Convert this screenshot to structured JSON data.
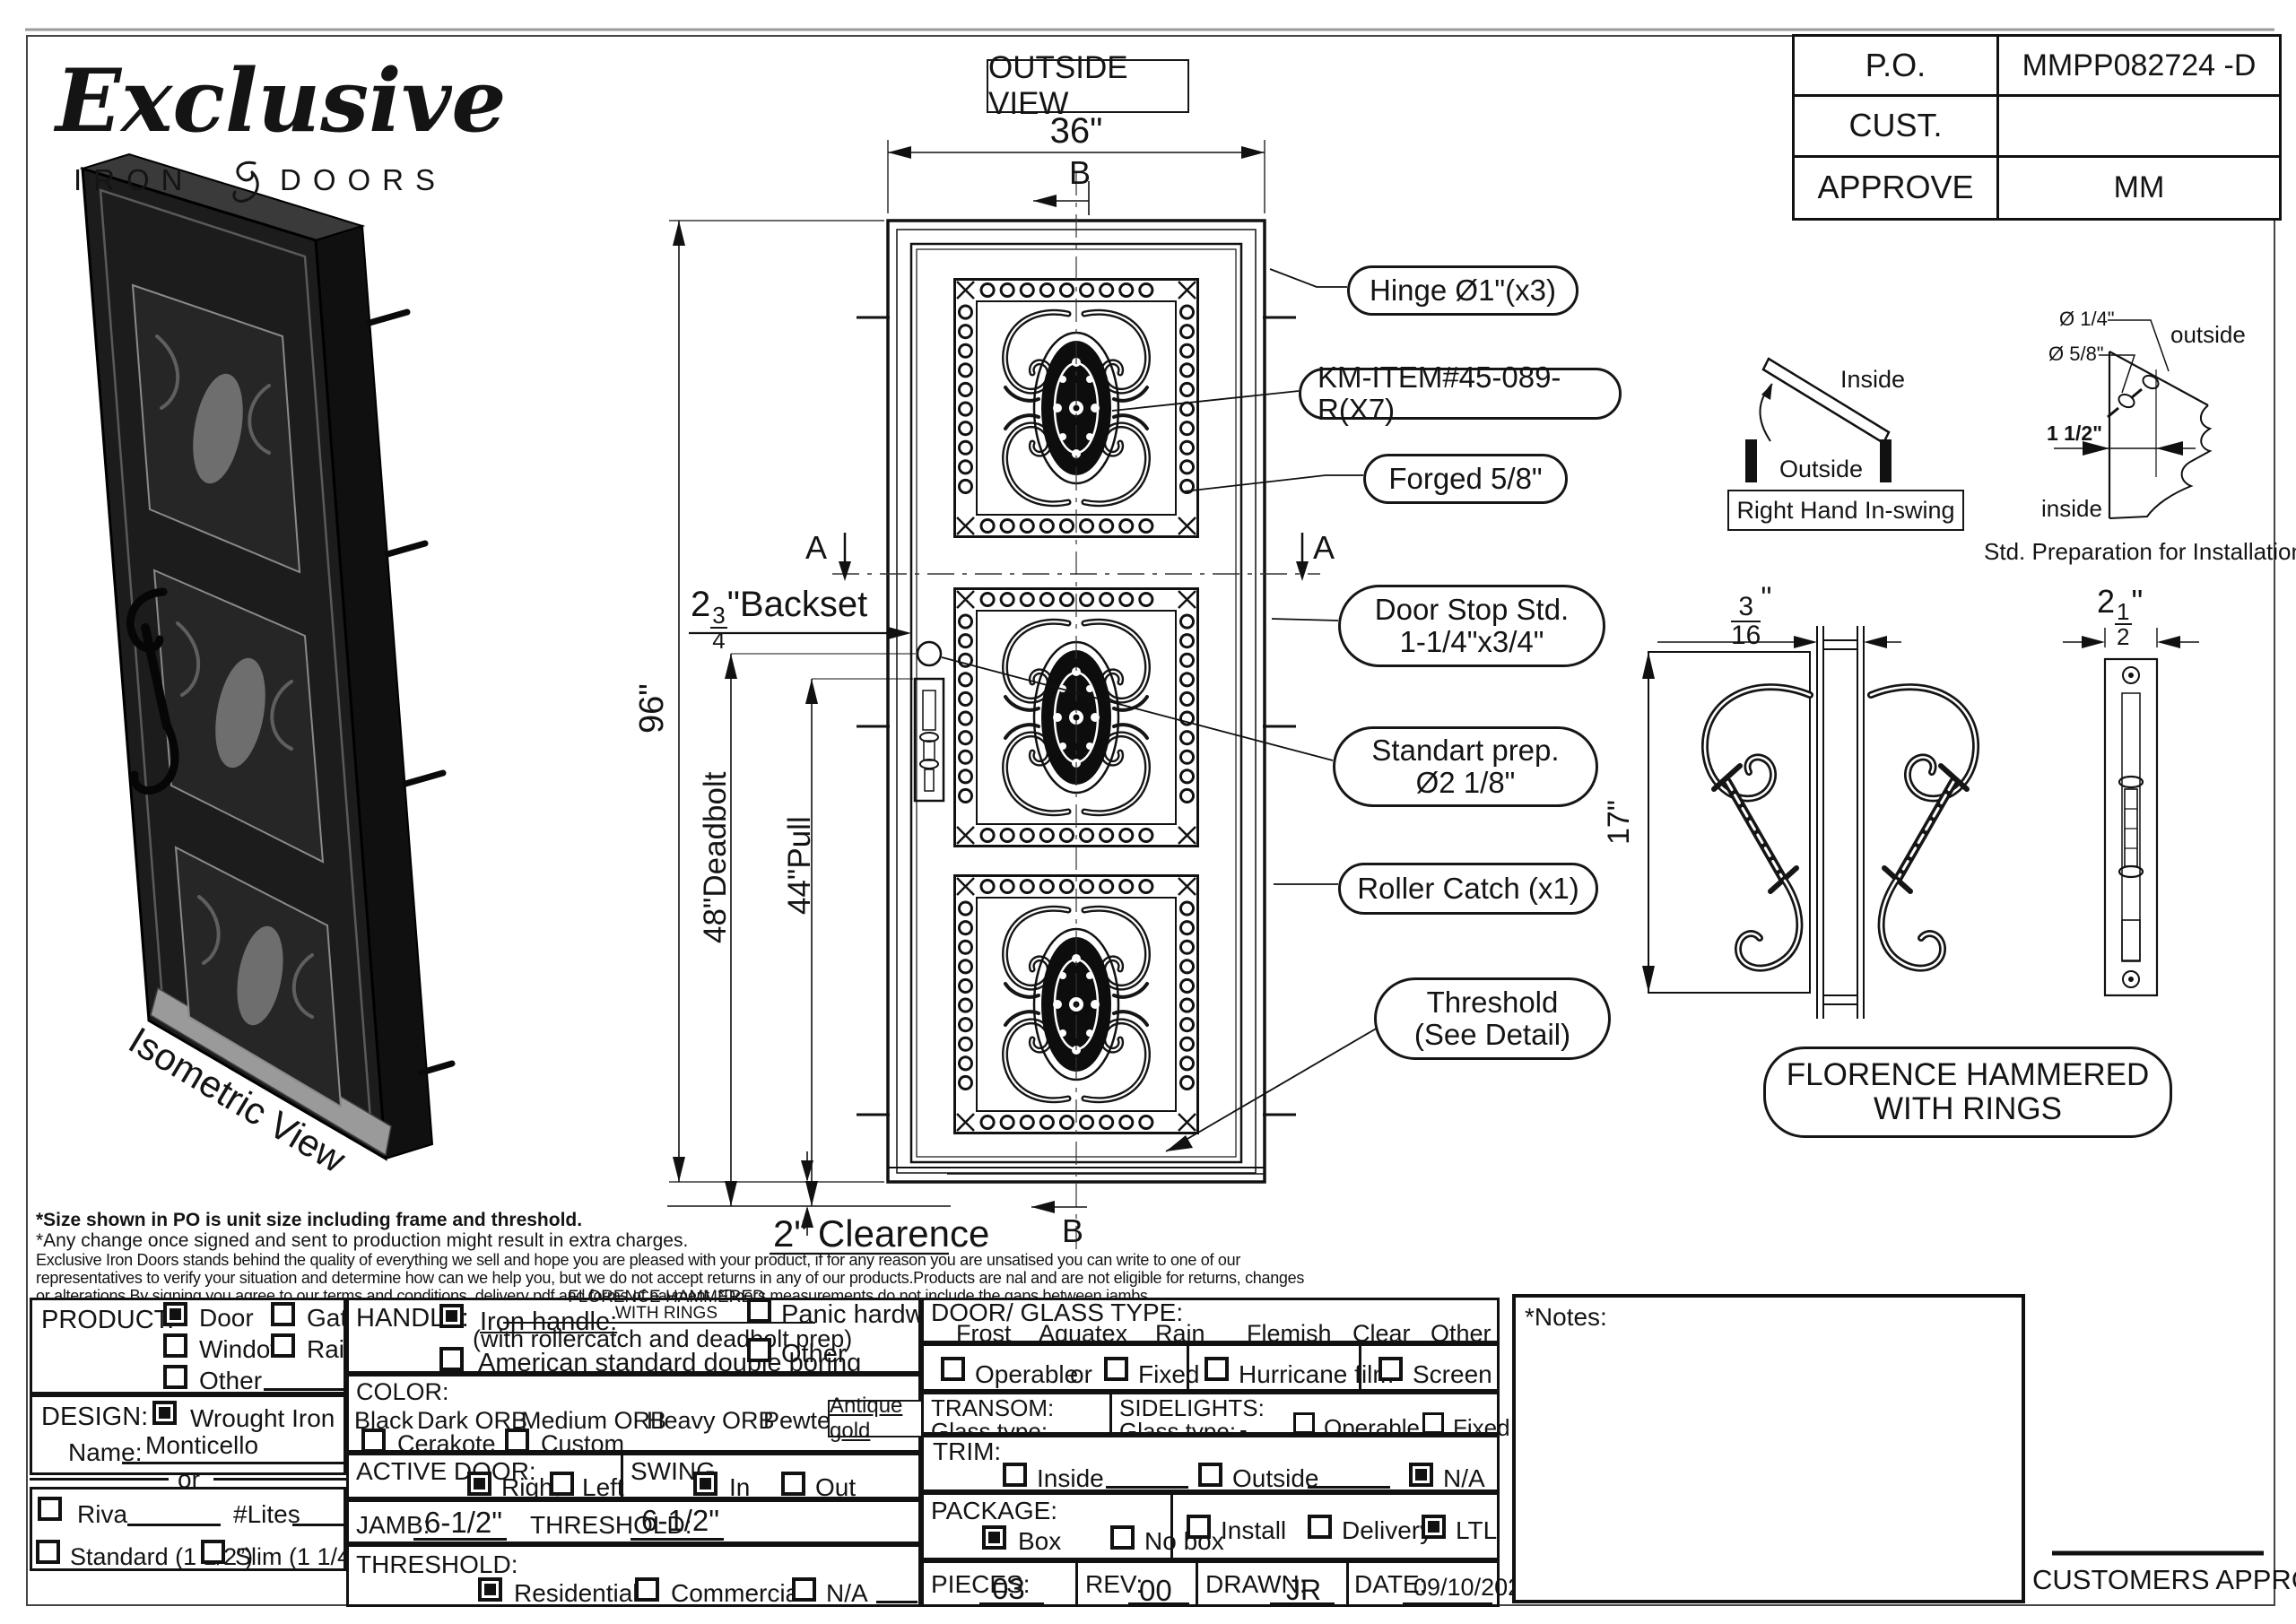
{
  "logo": {
    "name": "Exclusive",
    "tagline_left": "IRON",
    "tagline_right": "DOORS"
  },
  "po_table": {
    "po_label": "P.O.",
    "po_value": "MMPP082724 -D",
    "cust_label": "CUST.",
    "cust_value": "",
    "approve_label": "APPROVE",
    "approve_value": "MM"
  },
  "drawing": {
    "view_title": "OUTSIDE VIEW",
    "width_dim": "36\"",
    "height_dim": "96\"",
    "section_a": "A",
    "section_b": "B",
    "backset_whole": "2",
    "backset_num": "3",
    "backset_den": "4",
    "backset_text": "\"Backset",
    "deadbolt_dim": "48\"Deadbolt",
    "pull_dim": "44\"Pull",
    "clearance_dim": "2\" Clearence",
    "callouts": {
      "hinge": "Hinge Ø1\"(x3)",
      "km_item": "KM-ITEM#45-089-R(X7)",
      "forged": "Forged 5/8\"",
      "door_stop_1": "Door Stop Std.",
      "door_stop_2": "1-1/4\"x3/4\"",
      "prep_1": "Standart prep.",
      "prep_2": "Ø2 1/8\"",
      "roller": "Roller Catch (x1)",
      "threshold_1": "Threshold",
      "threshold_2": "(See Detail)"
    },
    "isometric_label": "Isometric View"
  },
  "swing_diagram": {
    "inside": "Inside",
    "outside": "Outside",
    "label": "Right Hand In-swing"
  },
  "prep_diagram": {
    "dia1": "Ø 1/4\"",
    "dia2": "Ø 5/8\"",
    "offset": "1 1/2\"",
    "outside": "outside",
    "inside": "inside",
    "caption": "Std. Preparation for Installation"
  },
  "handle_detail": {
    "gap_num": "3",
    "gap_den": "16",
    "gap_unit": "\"",
    "height_dim": "17\"",
    "width_whole": "2",
    "width_num": "1",
    "width_den": "2",
    "width_unit": "\"",
    "name_line1": "FLORENCE HAMMERED",
    "name_line2": "WITH RINGS"
  },
  "disclaimer": {
    "line1": "*Size shown in PO is unit size including frame and threshold.",
    "line2": "*Any change once signed and sent to production might result in extra charges.",
    "line3": "Exclusive Iron Doors stands behind the quality of everything we sell and hope you are pleased with your product, if for any reason you are unsatised you can write to one of our",
    "line4": "representatives to verify your situation and determine how can we help you, but we do not accept returns in any of our products.Products are nal and are not eligible for returns, changes",
    "line5": "or alterations.By signing you agree to our terms and conditions, delivery pdf and forms of payment. *Doors measurements do not include the gaps between jambs"
  },
  "form": {
    "product": {
      "label": "PRODUCT:",
      "options": [
        {
          "label": "Door",
          "checked": true
        },
        {
          "label": "Gate",
          "checked": false
        },
        {
          "label": "Window",
          "checked": false
        },
        {
          "label": "Railling",
          "checked": false
        },
        {
          "label": "Other",
          "checked": false
        }
      ]
    },
    "design": {
      "label": "DESIGN:",
      "wrought": {
        "label": "Wrought Iron",
        "checked": true
      },
      "name_label": "Name:",
      "name_value": "Monticello",
      "or": "or",
      "riva": {
        "label": "Riva",
        "checked": false
      },
      "lites_label": "#Lites",
      "standard": {
        "label": "Standard (1 1/2”)",
        "checked": false
      },
      "slim": {
        "label": "Slim (1 1/4”)",
        "checked": false
      }
    },
    "handle": {
      "label": "HANDLE:",
      "iron": {
        "label": "Iron handle:",
        "checked": true
      },
      "iron_value1": "FLORENCE HAMMERED",
      "iron_value2": "WITH RINGS",
      "iron_sub": "(with rollercatch and deadbolt prep)",
      "american": {
        "label": "American standard double boring",
        "checked": false
      },
      "panic": {
        "label": "Panic hardware",
        "checked": false
      },
      "other": {
        "label": "Other",
        "checked": false
      }
    },
    "color": {
      "label": "COLOR:",
      "opt1": "Black",
      "opt2": "Dark ORB",
      "opt3": "Medium ORB",
      "opt4": "Heavy ORB",
      "opt5": "Pewter",
      "selected": "Antique gold",
      "cerakote": {
        "label": "Cerakote",
        "checked": false
      },
      "custom": {
        "label": "Custom",
        "checked": false
      }
    },
    "active_door": {
      "label": "ACTIVE DOOR:",
      "right": {
        "label": "Right",
        "checked": true
      },
      "left": {
        "label": "Left",
        "checked": false
      }
    },
    "swing": {
      "label": "SWING",
      "in": {
        "label": "In",
        "checked": true
      },
      "out": {
        "label": "Out",
        "checked": false
      }
    },
    "jamb": {
      "label": "JAMB:",
      "value": "6-1/2\"",
      "threshold_label": "THRESHOLD:",
      "threshold_value": "6-1/2\""
    },
    "threshold": {
      "label": "THRESHOLD:",
      "residential": {
        "label": "Residential",
        "checked": true
      },
      "commercial": {
        "label": "Commercial",
        "checked": false
      },
      "na": {
        "label": "N/A",
        "checked": false
      }
    },
    "glass": {
      "label": "DOOR/ GLASS TYPE:",
      "opt1": "Frost",
      "opt2": "Aquatex",
      "opt3": "Rain",
      "opt4": "Flemish",
      "opt5": "Clear",
      "opt6": "Other",
      "operable": {
        "label": "Operable",
        "checked": false
      },
      "or": "or",
      "fixed": {
        "label": "Fixed",
        "checked": false
      },
      "hurricane": {
        "label": "Hurricane film",
        "checked": false
      },
      "screen": {
        "label": "Screen",
        "checked": false
      }
    },
    "transom": {
      "label": "TRANSOM:",
      "glass_type_label": "Glass type:"
    },
    "sidelights": {
      "label": "SIDELIGHTS:",
      "glass_type_label": "Glass type:",
      "glass_type_value": "-",
      "operable": {
        "label": "Operable",
        "checked": false
      },
      "fixed": {
        "label": "Fixed",
        "checked": false
      }
    },
    "trim": {
      "label": "TRIM:",
      "inside": {
        "label": "Inside",
        "checked": false
      },
      "outside": {
        "label": "Outside",
        "checked": false
      },
      "na": {
        "label": "N/A",
        "checked": true
      }
    },
    "package": {
      "label": "PACKAGE:",
      "box": {
        "label": "Box",
        "checked": true
      },
      "nobox": {
        "label": "No box",
        "checked": false
      },
      "install": {
        "label": "Install",
        "checked": false
      },
      "delivery": {
        "label": "Delivery",
        "checked": false
      },
      "ltl": {
        "label": "LTL",
        "checked": true
      }
    },
    "meta": {
      "pieces_label": "PIECES:",
      "pieces": "03",
      "rev_label": "REV:",
      "rev": "00",
      "drawn_label": "DRAWN:",
      "drawn": "JR",
      "date_label": "DATE:",
      "date": "09/10/2024"
    },
    "notes_label": "*Notes:",
    "approval_label": "CUSTOMERS APPROVAL"
  }
}
